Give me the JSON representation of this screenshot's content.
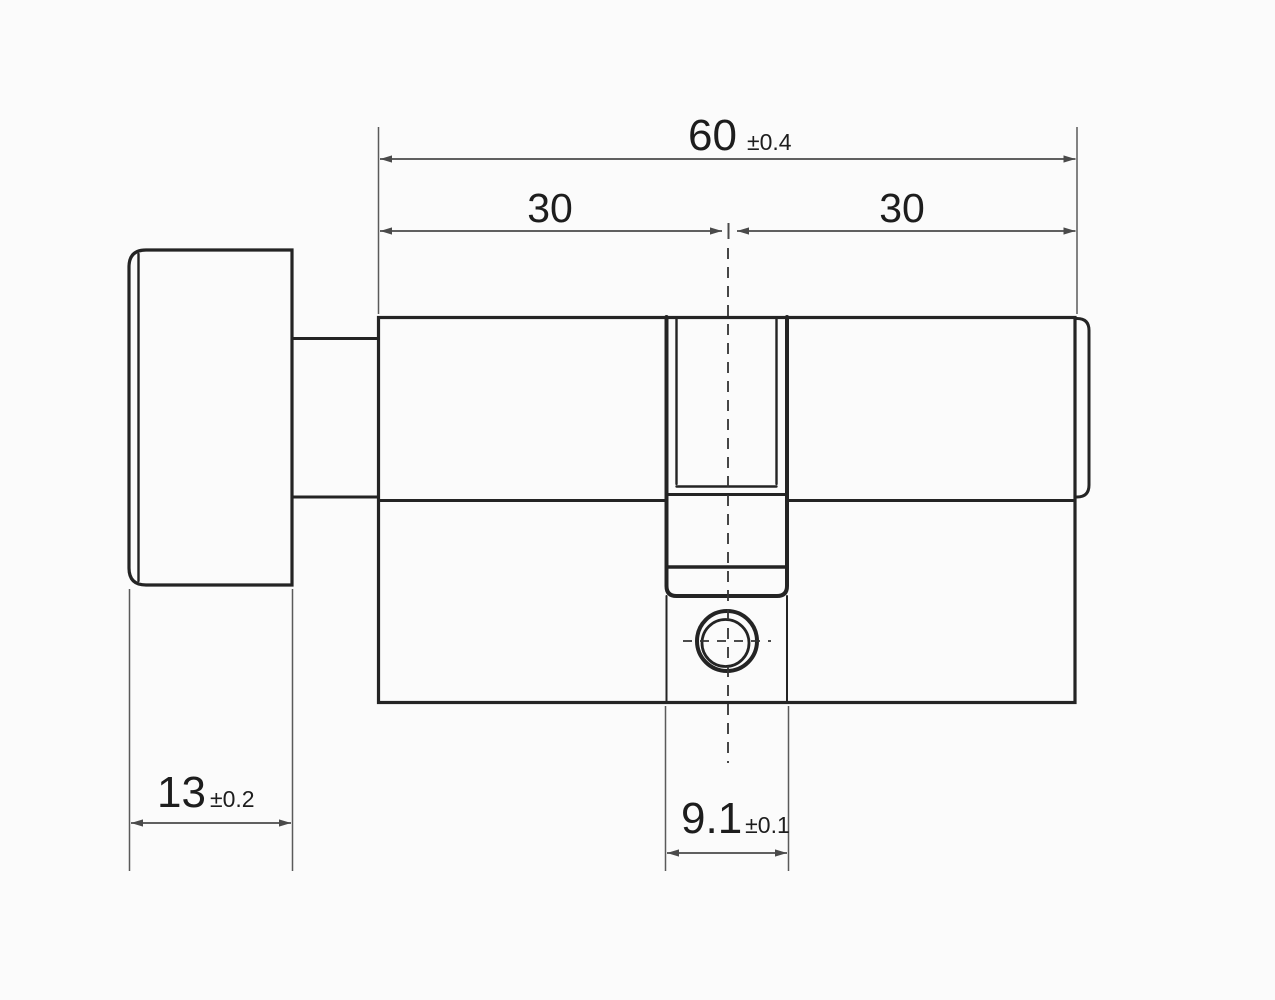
{
  "drawing": {
    "colors": {
      "background": "#fbfbfb",
      "outline": "#242424",
      "dimension_lines": "#4a4a4a",
      "text": "#1d1d1d"
    },
    "labels": {
      "total_length": {
        "value": "60",
        "tolerance": "±0.4"
      },
      "left_half": {
        "value": "30"
      },
      "right_half": {
        "value": "30"
      },
      "knob_depth": {
        "value": "13",
        "tolerance": "±0.2"
      },
      "cam_width": {
        "value": "9.1",
        "tolerance": "±0.1"
      }
    }
  }
}
